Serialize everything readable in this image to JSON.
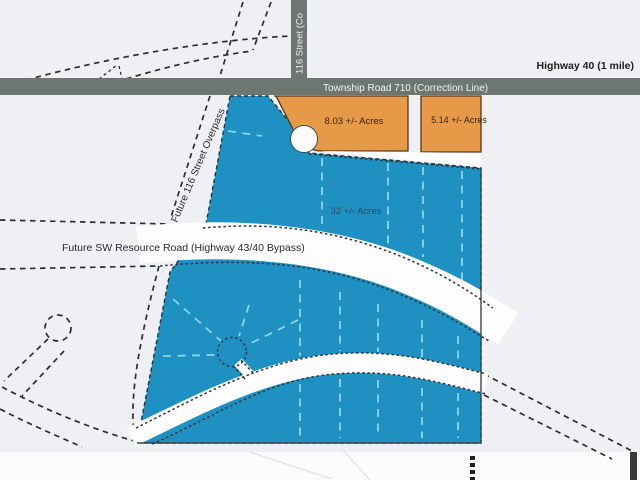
{
  "map": {
    "title": "Land parcel plat map",
    "labels": {
      "highway_40": "Highway 40 (1 mile)",
      "township_road": "Township Road 710 (Correction Line)",
      "street_116": "116 Street (Co",
      "overpass": "Future 116 Street Overpass",
      "sw_resource_road": "Future SW Resource Road (Highway 43/40 Bypass)",
      "parcel_orange_1": "8.03 +/- Acres",
      "parcel_orange_2": "5.14 +/- Acres",
      "parcel_blue": "32 +/- Acres"
    },
    "colors": {
      "background": "#eef0f3",
      "parcel_blue": "#1e90c2",
      "parcel_orange": "#e69a47",
      "road_gray": "#6e7672",
      "road_white": "#fdfdfd",
      "lot_line_cyan": "#8fd4e8"
    }
  }
}
